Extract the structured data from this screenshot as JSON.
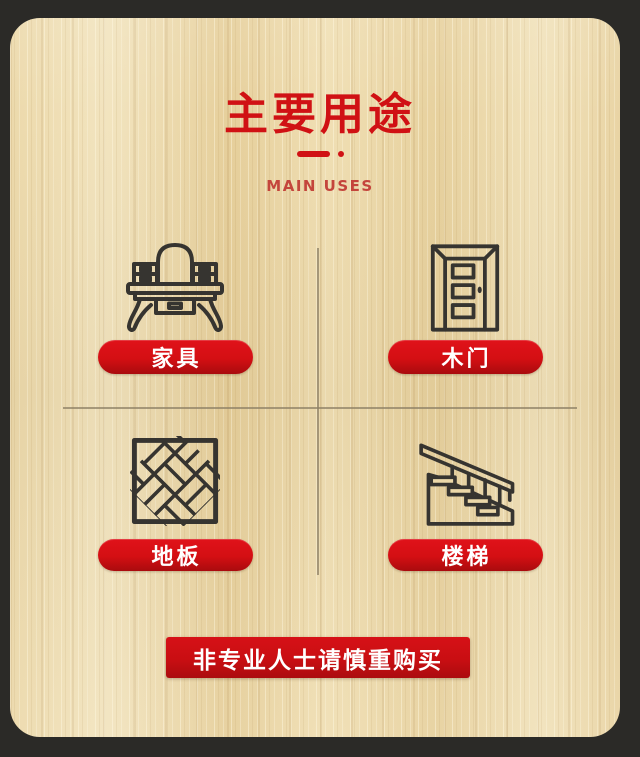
{
  "colors": {
    "outer_background": "#2b2a27",
    "wood_base": "#ebd6a7",
    "accent_red": "#d01114",
    "subtitle_red": "#c4453c",
    "button_red": "#d40f13",
    "icon_stroke": "#363430",
    "label_text": "#ffffff",
    "divider_line": "#8d8066"
  },
  "header": {
    "title": "主要用途",
    "subtitle": "MAIN USES"
  },
  "uses": [
    {
      "label": "家具",
      "icon": "vanity-table-icon"
    },
    {
      "label": "木门",
      "icon": "wooden-door-icon"
    },
    {
      "label": "地板",
      "icon": "parquet-floor-icon"
    },
    {
      "label": "楼梯",
      "icon": "staircase-icon"
    }
  ],
  "footer": {
    "warning": "非专业人士请慎重购买"
  }
}
